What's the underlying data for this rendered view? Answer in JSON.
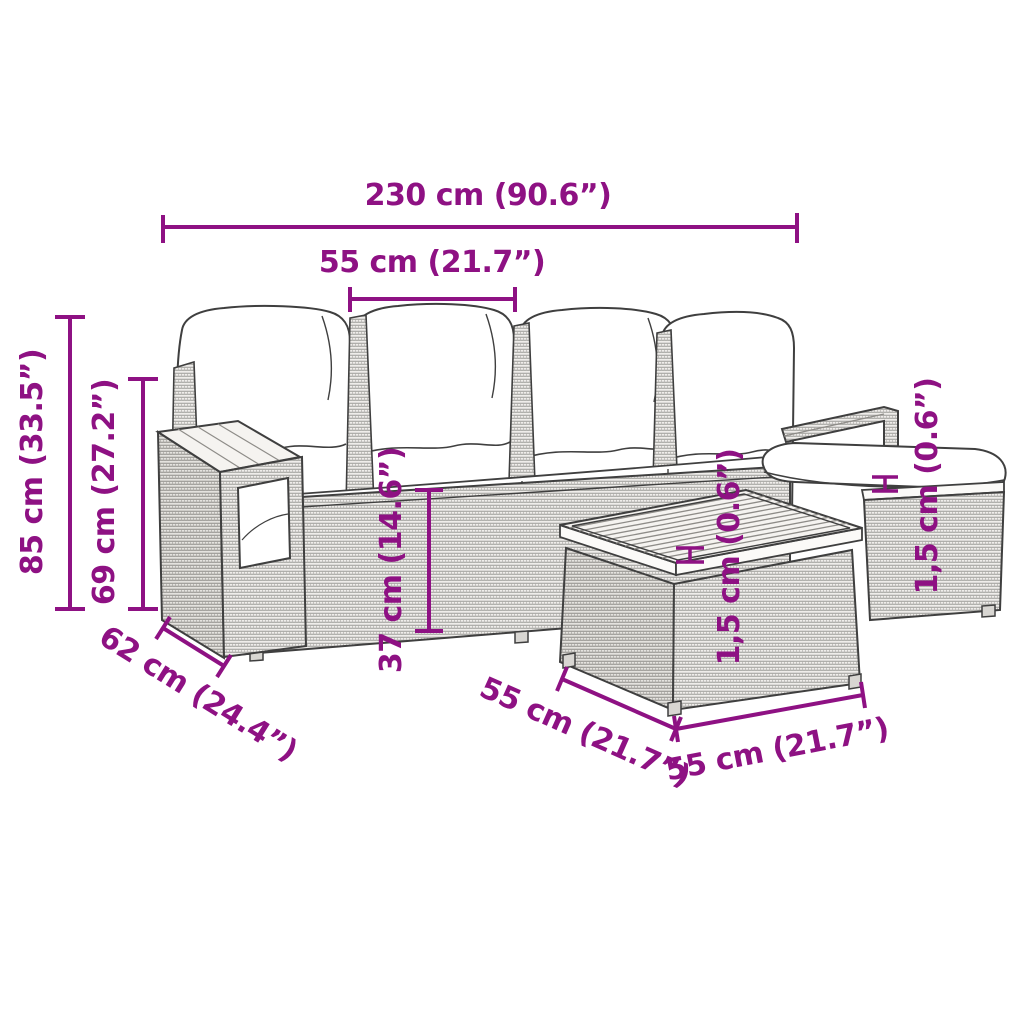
{
  "diagram": {
    "type": "product-dimension-diagram",
    "colors": {
      "accent": "#8E1183",
      "line": "#3F3F3F",
      "cushion": "#FFFFFF",
      "wicker_fill": "#EFEDEA",
      "wicker_line": "#9B9B98",
      "wood": "#F5F3F0"
    },
    "dimensions": {
      "total_width": {
        "label": "230 cm (90.6”)"
      },
      "seat_width": {
        "label": "55 cm (21.7”)"
      },
      "total_height": {
        "label": "85 cm (33.5”)"
      },
      "armrest_height": {
        "label": "69 cm (27.2”)"
      },
      "seat_height": {
        "label": "37 cm (14.6”)"
      },
      "seat_depth": {
        "label": "62 cm (24.4”)"
      },
      "table_depth": {
        "label": "55 cm (21.7”)"
      },
      "table_width": {
        "label": "55 cm (21.7”)"
      },
      "table_top_thickness": {
        "label": "1,5 cm (0.6”)"
      },
      "ottoman_top_thickness": {
        "label": "1,5 cm (0.6”)"
      }
    }
  }
}
